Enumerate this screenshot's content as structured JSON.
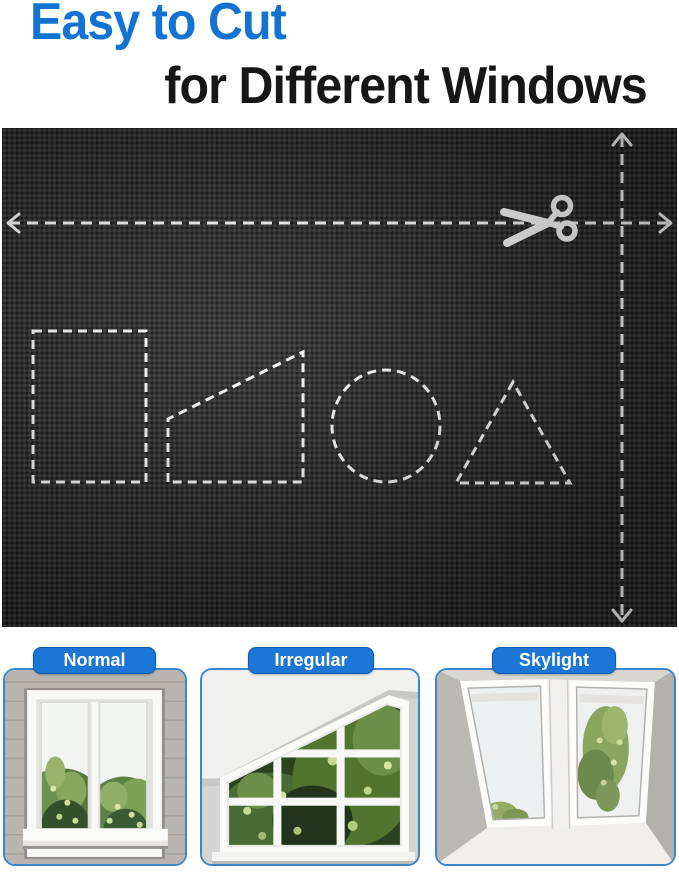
{
  "header": {
    "line1": "Easy to Cut",
    "line2": "for Different Windows"
  },
  "colors": {
    "accent_blue": "#1273d2",
    "headline_black": "#161616",
    "fabric_black": "#2c2c2c",
    "cut_guide_white": "#ffffff",
    "card_border_blue": "#3d85cb",
    "badge_blue": "#1b76d6"
  },
  "fabric_panel": {
    "icon": "scissors-icon",
    "cut_guides": [
      "horizontal-cut-line",
      "vertical-cut-line"
    ],
    "cut_shapes": [
      "rectangle",
      "right-trapezoid",
      "circle",
      "triangle"
    ]
  },
  "window_types": [
    {
      "label": "Normal"
    },
    {
      "label": "Irregular"
    },
    {
      "label": "Skylight"
    }
  ]
}
